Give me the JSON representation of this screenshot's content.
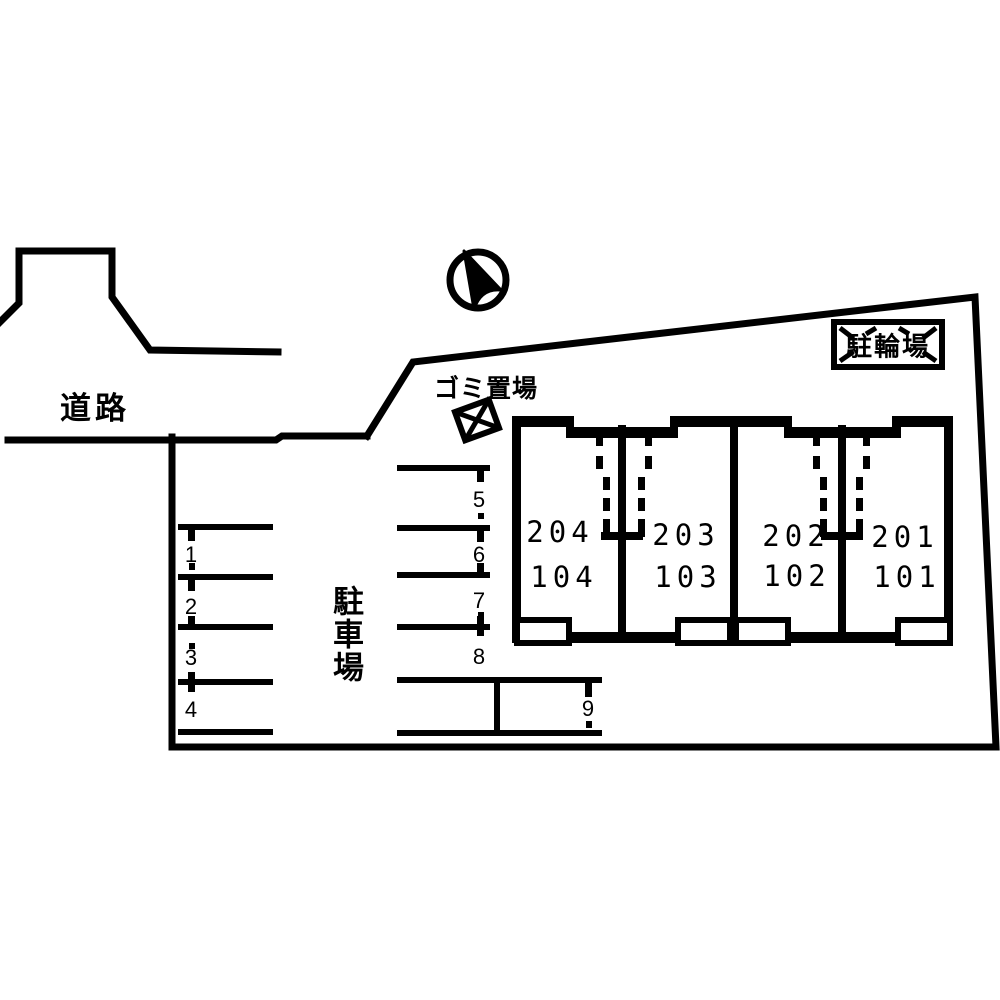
{
  "diagram": {
    "kind": "apartment-site-plan",
    "background_color": "#ffffff",
    "line_color": "#000000"
  },
  "labels": {
    "road": "道路",
    "parking_lot": "駐車場",
    "garbage_area": "ゴミ置場",
    "bicycle_parking": "駐輪場"
  },
  "icons": {
    "north_arrow": "compass-north-arrow",
    "garbage_marker": "crossed-box-marker",
    "stairs": "dashed-stair-lines"
  },
  "parking": {
    "spaces": [
      {
        "label": "1"
      },
      {
        "label": "2"
      },
      {
        "label": "3"
      },
      {
        "label": "4"
      },
      {
        "label": "5"
      },
      {
        "label": "6"
      },
      {
        "label": "7"
      },
      {
        "label": "8"
      },
      {
        "label": "9"
      }
    ]
  },
  "building": {
    "units": [
      {
        "upper": "204",
        "lower": "104"
      },
      {
        "upper": "203",
        "lower": "103"
      },
      {
        "upper": "202",
        "lower": "102"
      },
      {
        "upper": "201",
        "lower": "101"
      }
    ]
  }
}
